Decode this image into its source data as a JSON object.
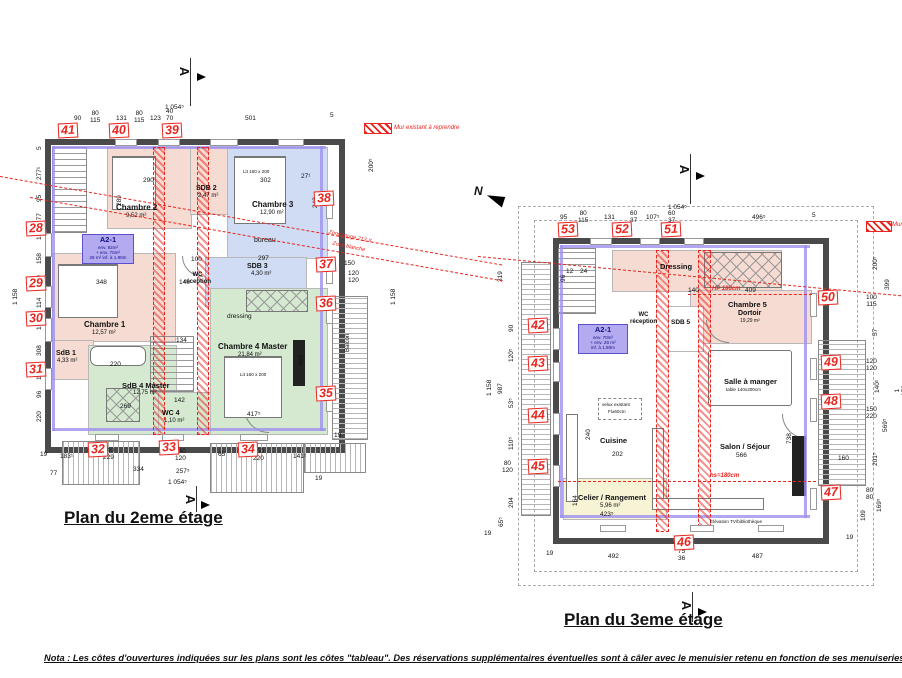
{
  "doc": {
    "nota": "Nota : Les côtes d'ouvertures indiquées sur les plans sont les côtes \"tableau\". Des réservations supplémentaires éventuelles sont à câler avec le menuisier retenu en fonction de ses menuiseries et son"
  },
  "p2": {
    "title": "Plan du 2eme étage",
    "section_letter": "A",
    "markers": [
      "28",
      "29",
      "30",
      "31",
      "32",
      "33",
      "34",
      "35",
      "36",
      "37",
      "38",
      "39",
      "40",
      "41"
    ],
    "apt": {
      "code": "A2-1",
      "l1": "env. 92m²",
      "l2": "+ env. 70m²",
      "l3": "26 m² inf. à 1.80m"
    },
    "rooms": {
      "chambre1": {
        "name": "Chambre 1",
        "area": "12,57 m²"
      },
      "chambre2": {
        "name": "Chambre 2",
        "area": "9,52 m²"
      },
      "chambre3": {
        "name": "Chambre 3",
        "area": "12,90 m²",
        "bed": "Lit 160 x 200"
      },
      "chambre4": {
        "name": "Chambre 4 Master",
        "area": "21,84 m²",
        "bed": "Lit 160 x 200"
      },
      "sdb1": {
        "name": "SdB 1",
        "area": "4,33 m²"
      },
      "sdb2": {
        "name": "SDB 2",
        "area": "2,47 m²"
      },
      "sdb3": {
        "name": "SDB 3",
        "area": "4,30 m²"
      },
      "sdb4": {
        "name": "SdB 4 Master",
        "area": "12,75 m²"
      },
      "wc4": {
        "name": "WC 4",
        "area": "1,10 m²"
      },
      "wc_reception": {
        "name": "WC\nréception"
      },
      "bureau": {
        "name": "bureau"
      },
      "dressing": {
        "name": "dressing"
      },
      "balcon": {
        "name": "Balcon"
      }
    },
    "ann": {
      "mur": "Mur existant à reprendre",
      "zone_rouge": "Zone rouge 212 X",
      "zone_blanche": "Zone blanche"
    },
    "dt": [
      "1 054⁵",
      "90",
      "80\n115",
      "131",
      "80\n115",
      "123",
      "40\n70",
      "501",
      "5"
    ],
    "db": [
      "19",
      "183¹",
      "140\n229",
      "334",
      "140\n120",
      "257⁵",
      "65",
      "150\n220",
      "141¹",
      "77",
      "1 054⁵",
      "19"
    ],
    "dl": [
      "5",
      "277¹",
      "95",
      "177",
      "12",
      "158",
      "120",
      "114",
      "100",
      "308",
      "110",
      "96",
      "220",
      "1 158"
    ],
    "dr": [
      "200⁵",
      "150",
      "120\n120",
      "1 158",
      "19"
    ],
    "di": [
      "290",
      "302",
      "348",
      "140",
      "100",
      "297",
      "220",
      "134",
      "269",
      "142",
      "417⁵",
      "463",
      "240",
      "289",
      "27¹"
    ]
  },
  "p3": {
    "title": "Plan du 3eme étage",
    "section_letter": "A",
    "north": "N",
    "markers": [
      "42",
      "43",
      "44",
      "45",
      "46",
      "47",
      "48",
      "49",
      "50",
      "51",
      "52",
      "53"
    ],
    "apt": {
      "code": "A2-1",
      "l1": "env. 70m²",
      "l2": "+ env. 26 m²",
      "l3": "inf. à 1.80m"
    },
    "rooms": {
      "dressing": {
        "name": "Dressing"
      },
      "chambre5": {
        "name": "Chambre 5",
        "sub": "Dortoir",
        "area": "19,29 m²"
      },
      "sdb5": {
        "name": "SDB 5"
      },
      "wc_reception": {
        "name": "WC\nréception"
      },
      "salle": {
        "name": "Salle à manger",
        "sub": "table 140x200cm"
      },
      "cuisine": {
        "name": "Cuisine"
      },
      "velux": {
        "name": "velux existant",
        "sub": "Fl±60cm"
      },
      "salon": {
        "name": "Salon / Séjour",
        "dim": "566"
      },
      "cellier": {
        "name": "Celier / Rangement",
        "area": "5,96 m²"
      },
      "elevation": {
        "name": "Elévation TV/bibliothèque"
      }
    },
    "ann": {
      "mur": "Mur existant à reprendre",
      "hp": "HP 180cm",
      "hs": "hs=180cm"
    },
    "dt": [
      "1 054⁵",
      "95",
      "80\n115",
      "131",
      "60\n37",
      "107⁵",
      "60\n37",
      "496⁵",
      "5"
    ],
    "db": [
      "19",
      "492",
      "75\n36",
      "487"
    ],
    "dl": [
      "319",
      "90",
      "120⁵",
      "987",
      "1 158",
      "53⁵",
      "110⁵",
      "80\n120",
      "204",
      "65⁵",
      "19"
    ],
    "dr": [
      "200⁵",
      "399",
      "100\n115",
      "57",
      "120\n120",
      "140¹",
      "150\n220",
      "569⁵",
      "1 158",
      "160",
      "201⁵",
      "80\n80",
      "169⁵",
      "109",
      "19"
    ],
    "di": [
      "409",
      "140",
      "202",
      "240",
      "164",
      "423⁵",
      "738",
      "96",
      "24",
      "12"
    ]
  }
}
